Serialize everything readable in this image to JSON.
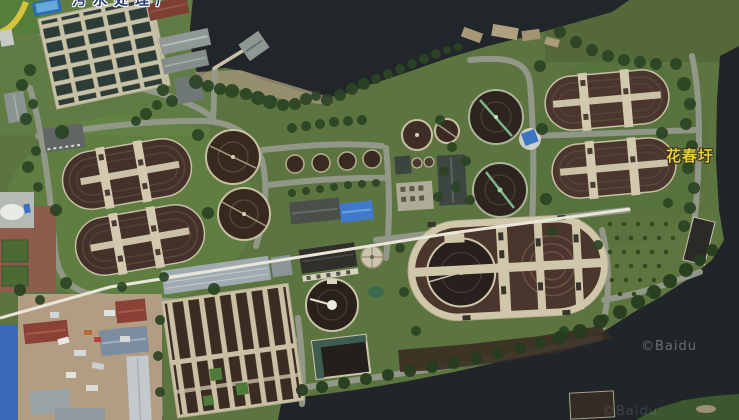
{
  "map": {
    "type": "satellite-imagery",
    "place_labels": [
      {
        "id": "top-edge-partial",
        "text": "污水处理厂",
        "color": "#22386b",
        "outline": "#ffffff",
        "note": "clipped at top edge of viewport"
      },
      {
        "id": "huachunwei",
        "text": "花春圩",
        "color": "#e2cc3b",
        "outline": "#3a2f10"
      }
    ],
    "watermarks": [
      {
        "text": "©Baidu",
        "opacity": 0.5
      },
      {
        "text": "©Baidu",
        "opacity": 0.22
      }
    ],
    "palette": {
      "water": "#20262a",
      "grass": "#5c7440",
      "trees": "#2b4423",
      "road": "#949a8c",
      "tank_dark": "#2d2420",
      "basin_brown": "#4a362c",
      "walkway_cream": "#d0c7ab",
      "blue_roof": "#3f79cc",
      "red_roof": "#8a4136",
      "yellow_label": "#e2cc3b"
    }
  }
}
